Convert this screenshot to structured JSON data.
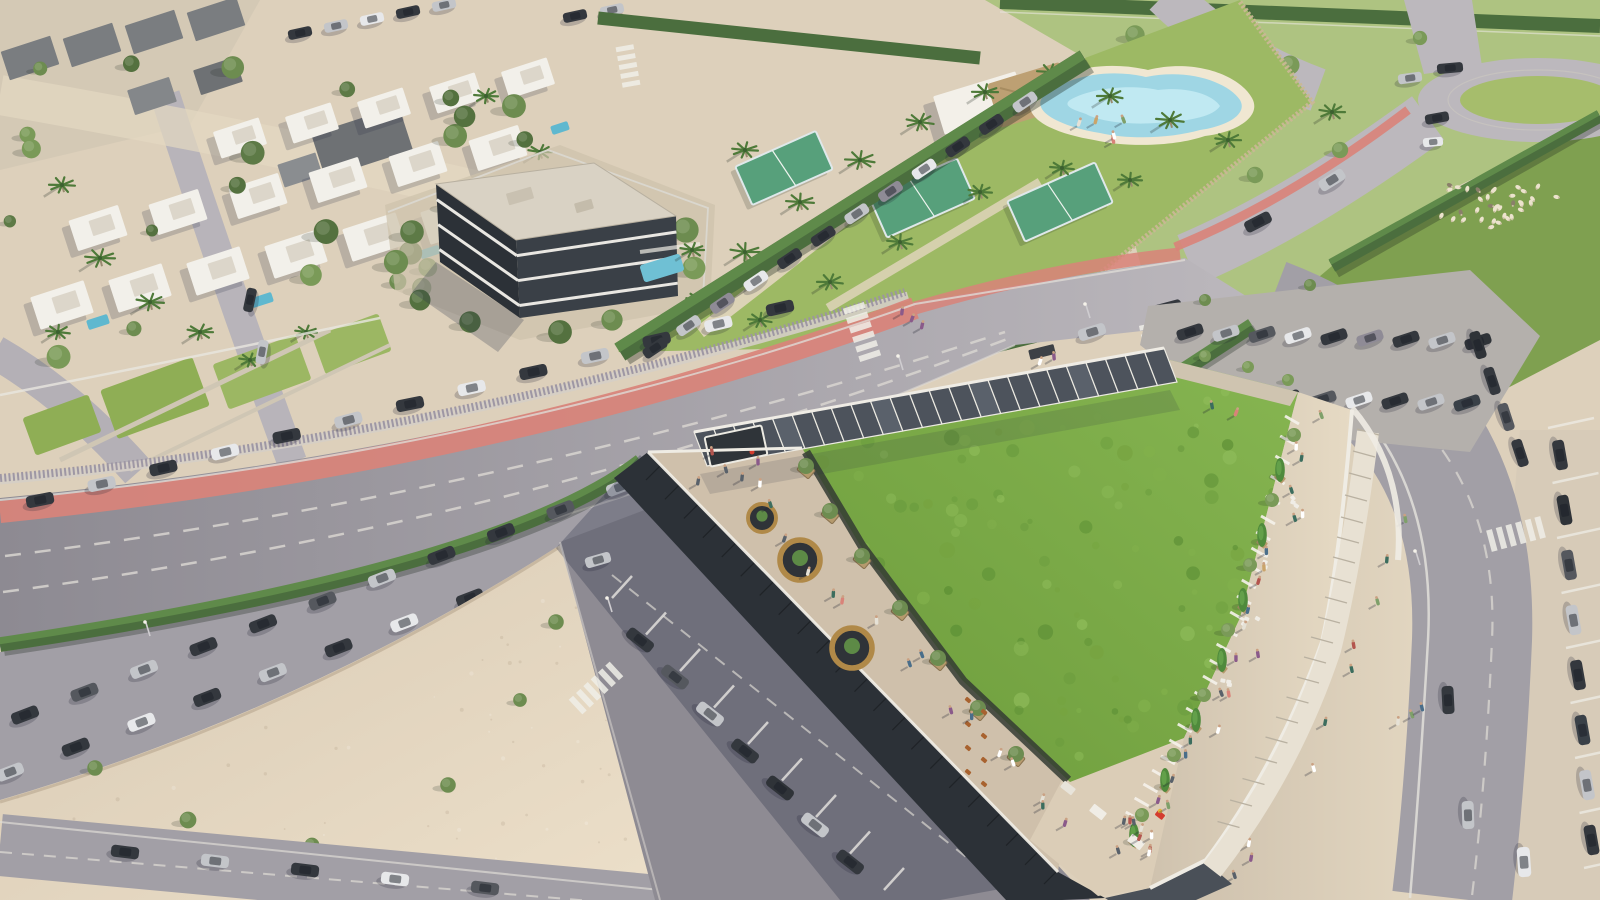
{
  "scene": {
    "type": "aerial-architectural-rendering",
    "time_of_day": "sunny daytime, sun from upper right casting long shadows to lower left",
    "features": {
      "green_roof_building": "Large low-rise building with an extensive wild-meadow green roof, photovoltaic canopy along its north edge, rooftop terrace with round timber seating pods, planters, cafe tables, market stalls and many pedestrians on a curved promenade",
      "boulevard": "Wide avenue running diagonally with dashed lane markings, salmon-red bike lane, slatted fence, hedge median, zebra crossings and rows of parked cars",
      "sports_club": "Hedge-walled leisure club with padel courts, lagoon-style pool, white clubhouse with thatched pavilion roof and many palm trees",
      "apartment_block": "Dark glass three-storey apartment building with flat light roof, white floor bands and private pool",
      "villa_district": "White flat-roofed villas with gardens, lawns, pools and street trees in the upper left",
      "roundabout": "Grass-centred roundabout at the top right with cars circulating",
      "sheep_meadow": "Small flock of sheep grazing on a grass verge near the roundabout",
      "parking": "Surface parking lots, angled on-street bays and kerbside parking full of grey, silver and white cars",
      "sand_esplanade": "Large unpaved sandy esplanade with young trees at the bottom left"
    },
    "palette": {
      "sand": "#ddd0bb",
      "sandLight": "#ecdfc9",
      "sandShade": "#cbbba3",
      "road": "#a29fa6",
      "roadLight": "#bcb8bd",
      "roadDark": "#8d8a92",
      "roadShade": "#6f6d78",
      "bikeLane": "#d98379",
      "grass": "#9db964",
      "grassField": "#aec381",
      "grassDark": "#7fa050",
      "greenRoof": "#79a845",
      "greenRoofDark": "#5f9136",
      "greenRoofLight": "#8fbc5a",
      "hedge": "#4b6e3e",
      "hedgeLight": "#5f8a4a",
      "pool": "#8ed0e0",
      "poolLight": "#c6ecf4",
      "court": "#57a07b",
      "thatch": "#bda073",
      "whiteWall": "#f2f0ea",
      "roofGray": "#d9d2c4",
      "darkFacade": "#2c3137",
      "facadeMid": "#3a4047",
      "solar": "#4d535c",
      "solarFrame": "#eceae2",
      "terrace": "#cfc0ab",
      "promenade": "#dbcdb7",
      "picketFence": "#c9b794",
      "slatFence": "#9b94a2",
      "carDark": "#34383e",
      "carSilver": "#c3c5c9",
      "carWhite": "#e7e8ea",
      "sheep": "#ece3cd",
      "shadow": "rgba(40,46,70,0.30)"
    }
  }
}
